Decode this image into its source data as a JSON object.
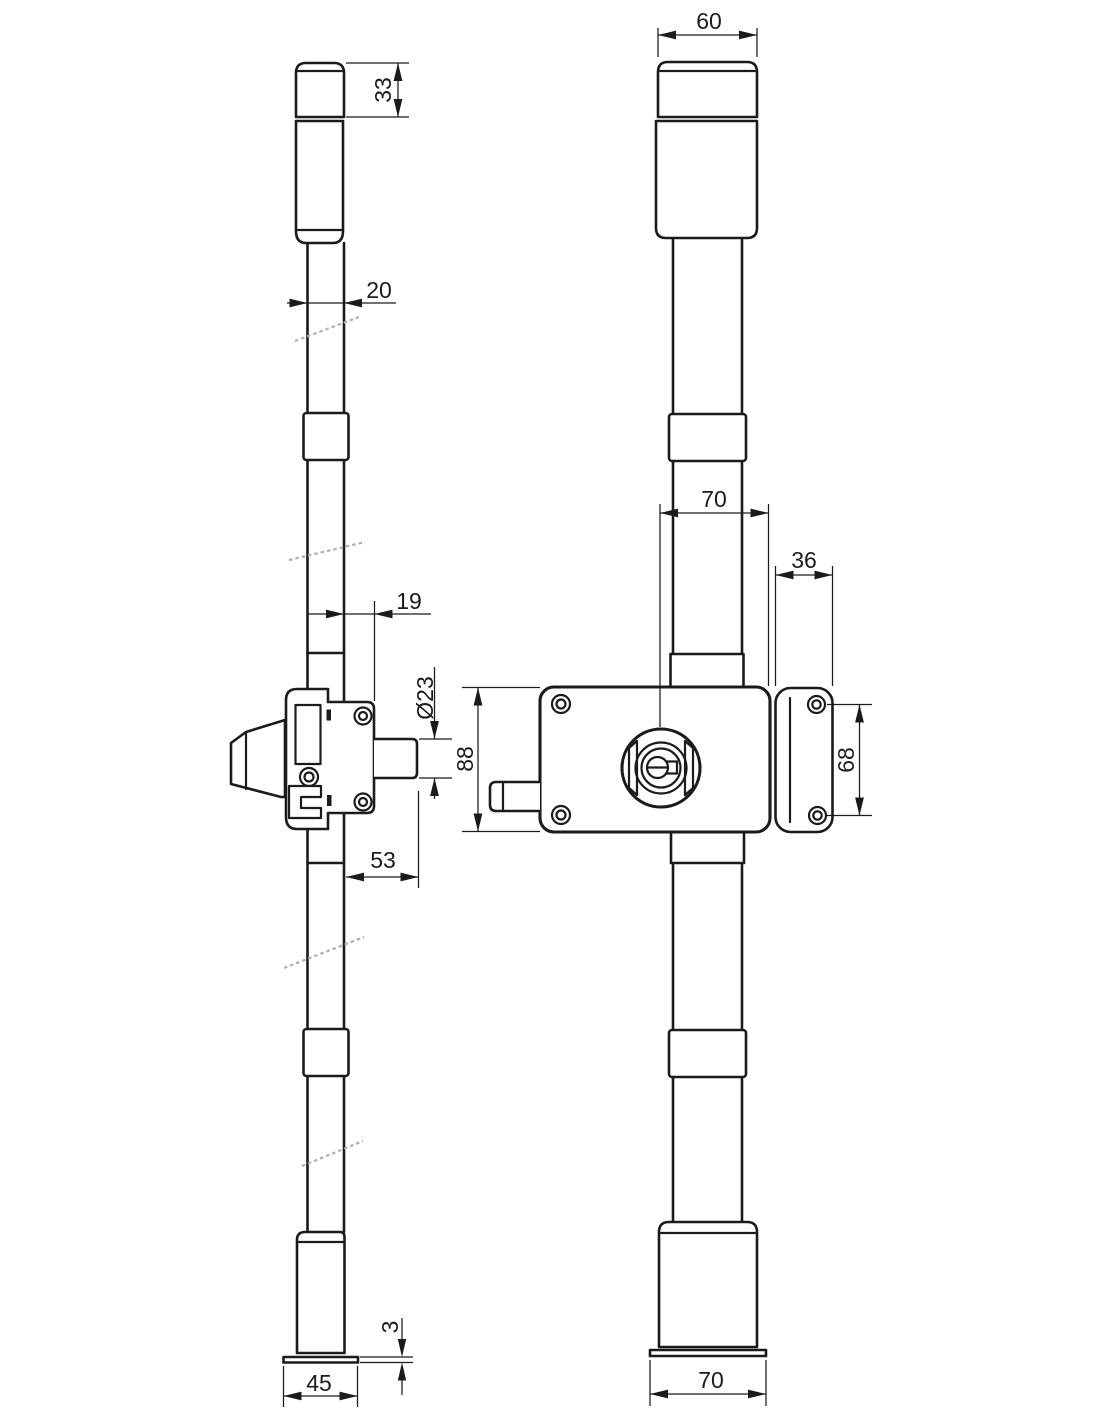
{
  "drawing": {
    "type": "technical-drawing-lock-with-vertical-rods",
    "colors": {
      "line": "#1b1b1b",
      "background": "#ffffff",
      "break": "#b0b0b0"
    },
    "dimensions": {
      "side_cap_height": "33",
      "side_rod_width": "20",
      "side_body_offset": "19",
      "side_cylinder_diameter": "Ø23",
      "side_body_depth": "53",
      "side_plate_thickness": "3",
      "side_foot_width": "45",
      "front_cap_width": "60",
      "front_cylinder_to_edge": "70",
      "front_striker_width": "36",
      "front_body_height": "88",
      "front_striker_screw_spacing": "68",
      "front_foot_width": "70"
    }
  }
}
